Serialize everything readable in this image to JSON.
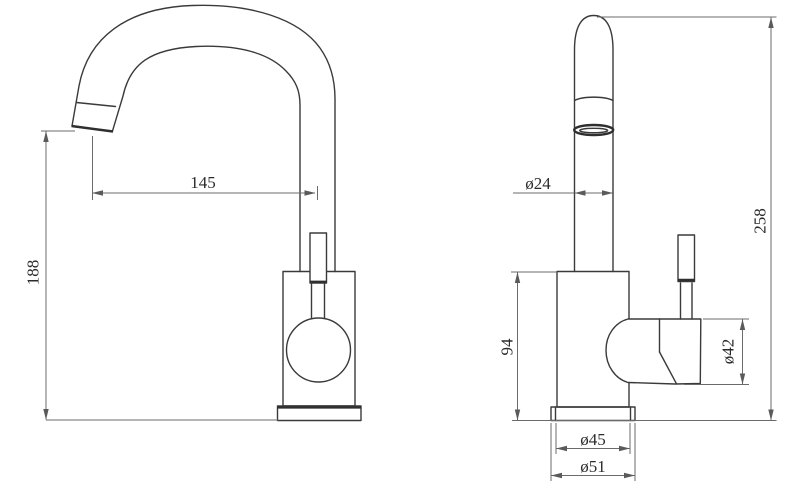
{
  "page": {
    "background": "#ffffff"
  },
  "drawing": {
    "type": "technical dimension drawing",
    "subject": "single-lever mixer faucet shown in two orthographic views (side view with gooseneck spout, front view with side handle)",
    "unit": "mm",
    "style": {
      "object_line_color": "#3a3a3a",
      "dimension_line_color": "#6b6b6b",
      "text_color": "#2b2b2b",
      "background": "#ffffff"
    },
    "views": [
      {
        "id": "side-view",
        "position": "left",
        "dimensions": [
          "spout_reach",
          "spout_outlet_height"
        ]
      },
      {
        "id": "front-view",
        "position": "right",
        "dimensions": [
          "spout_tube_diameter",
          "overall_height",
          "body_height",
          "handle_diameter",
          "base_inner_diameter",
          "base_outer_diameter"
        ]
      }
    ]
  },
  "dims": {
    "spout_reach": {
      "label": "145",
      "value": 145,
      "kind": "length",
      "orientation": "horizontal"
    },
    "spout_outlet_height": {
      "label": "188",
      "value": 188,
      "kind": "length",
      "orientation": "vertical"
    },
    "spout_tube_diameter": {
      "label": "ø24",
      "value": 24,
      "kind": "diameter",
      "orientation": "horizontal"
    },
    "overall_height": {
      "label": "258",
      "value": 258,
      "kind": "length",
      "orientation": "vertical"
    },
    "body_height": {
      "label": "94",
      "value": 94,
      "kind": "length",
      "orientation": "vertical"
    },
    "handle_diameter": {
      "label": "ø42",
      "value": 42,
      "kind": "diameter",
      "orientation": "vertical"
    },
    "base_inner_diameter": {
      "label": "ø45",
      "value": 45,
      "kind": "diameter",
      "orientation": "horizontal"
    },
    "base_outer_diameter": {
      "label": "ø51",
      "value": 51,
      "kind": "diameter",
      "orientation": "horizontal"
    }
  }
}
